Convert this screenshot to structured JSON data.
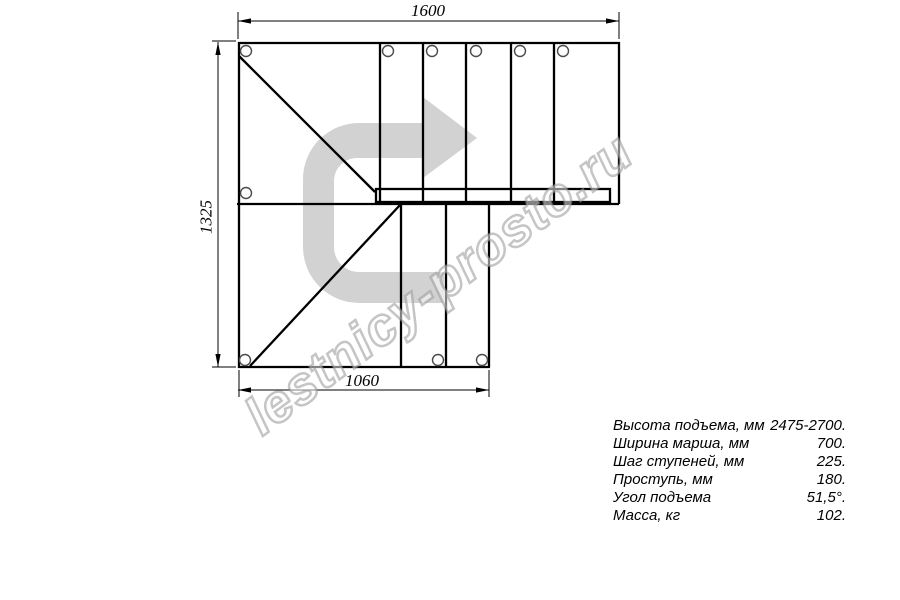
{
  "watermark": {
    "text": "lestnicy-prosto.ru"
  },
  "dimensions": {
    "top": "1600",
    "left": "1325",
    "bottom": "1060"
  },
  "specs": {
    "rows": [
      {
        "label": "Высота подъема, мм",
        "value": "2475-2700."
      },
      {
        "label": "Ширина марша, мм",
        "value": "700."
      },
      {
        "label": "Шаг ступеней, мм",
        "value": "225."
      },
      {
        "label": "Проступь, мм",
        "value": "180."
      },
      {
        "label": "Угол подъема",
        "value": "51,5°."
      },
      {
        "label": "Масса, кг",
        "value": "102."
      }
    ]
  },
  "colors": {
    "line": "#000000",
    "arrow_fill": "#d2d2d2",
    "watermark_outline": "#969696"
  }
}
